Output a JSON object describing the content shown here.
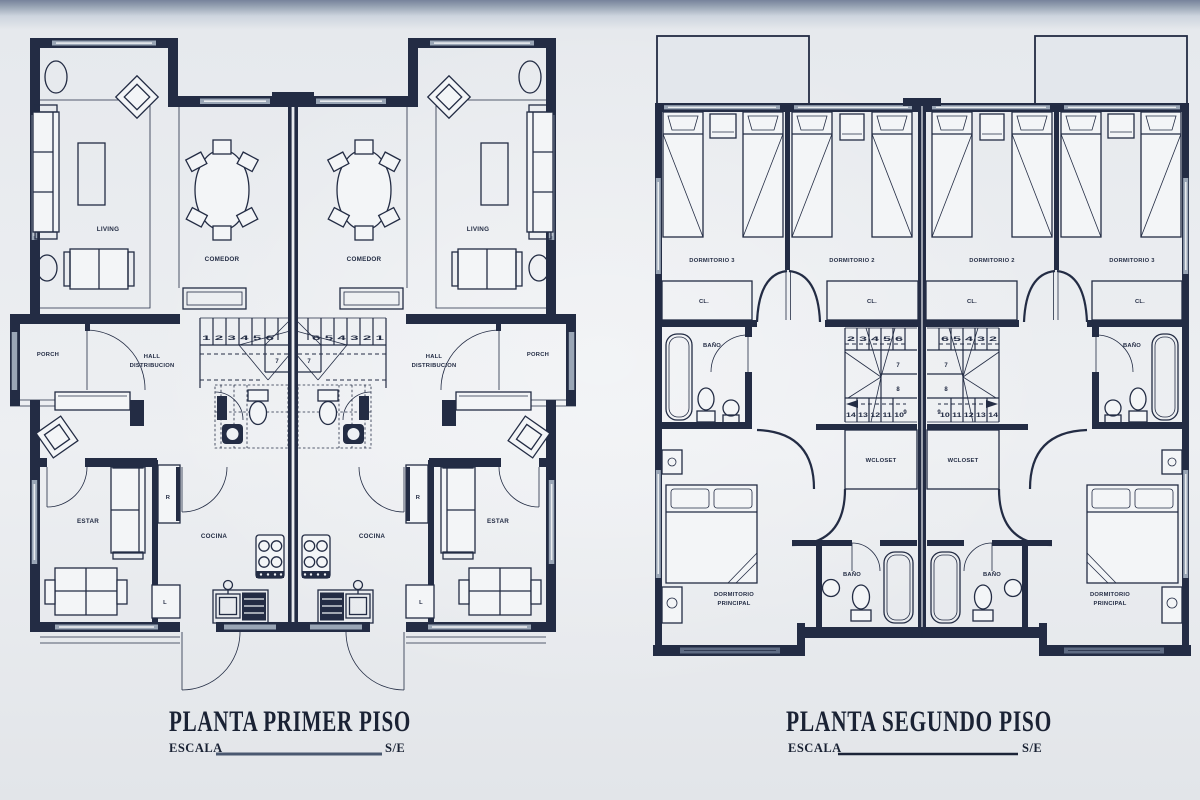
{
  "theme": {
    "background": "#e8ebee",
    "ink": "#232c44",
    "wall_gray": "#9aa6b6",
    "top_band": "#6f7c92"
  },
  "first_floor": {
    "title": "PLANTA PRIMER PISO",
    "scale_label": "ESCALA",
    "scale_value": "S/E",
    "labels": {
      "living": "LIVING",
      "comedor": "COMEDOR",
      "porch": "PORCH",
      "hall_line1": "HALL",
      "hall_line2": "DISTRIBUCION",
      "estar": "ESTAR",
      "cocina": "COCINA",
      "refrigerator": "R",
      "laundry": "L"
    },
    "stairs": {
      "run": "1 2 3 4 5 6",
      "run_mirrored": "6 5 4 3 2 1",
      "step7": "7"
    }
  },
  "second_floor": {
    "title": "PLANTA SEGUNDO PISO",
    "scale_label": "ESCALA",
    "scale_value": "S/E",
    "labels": {
      "dormitorio3": "DORMITORIO 3",
      "dormitorio2": "DORMITORIO 2",
      "closet": "CL.",
      "bath": "BAÑO",
      "wcloset": "WCLOSET",
      "dorm_principal_line1": "DORMITORIO",
      "dorm_principal_line2": "PRINCIPAL"
    },
    "stairs": {
      "upper_run": "2 3 4 5 6",
      "upper_run_mirrored": "6 5 4 3 2",
      "step7": "7",
      "step8": "8",
      "step9": "9",
      "lower_run": "14 13 12 11 10",
      "lower_run_mirrored": "10 11 12 13 14"
    }
  }
}
